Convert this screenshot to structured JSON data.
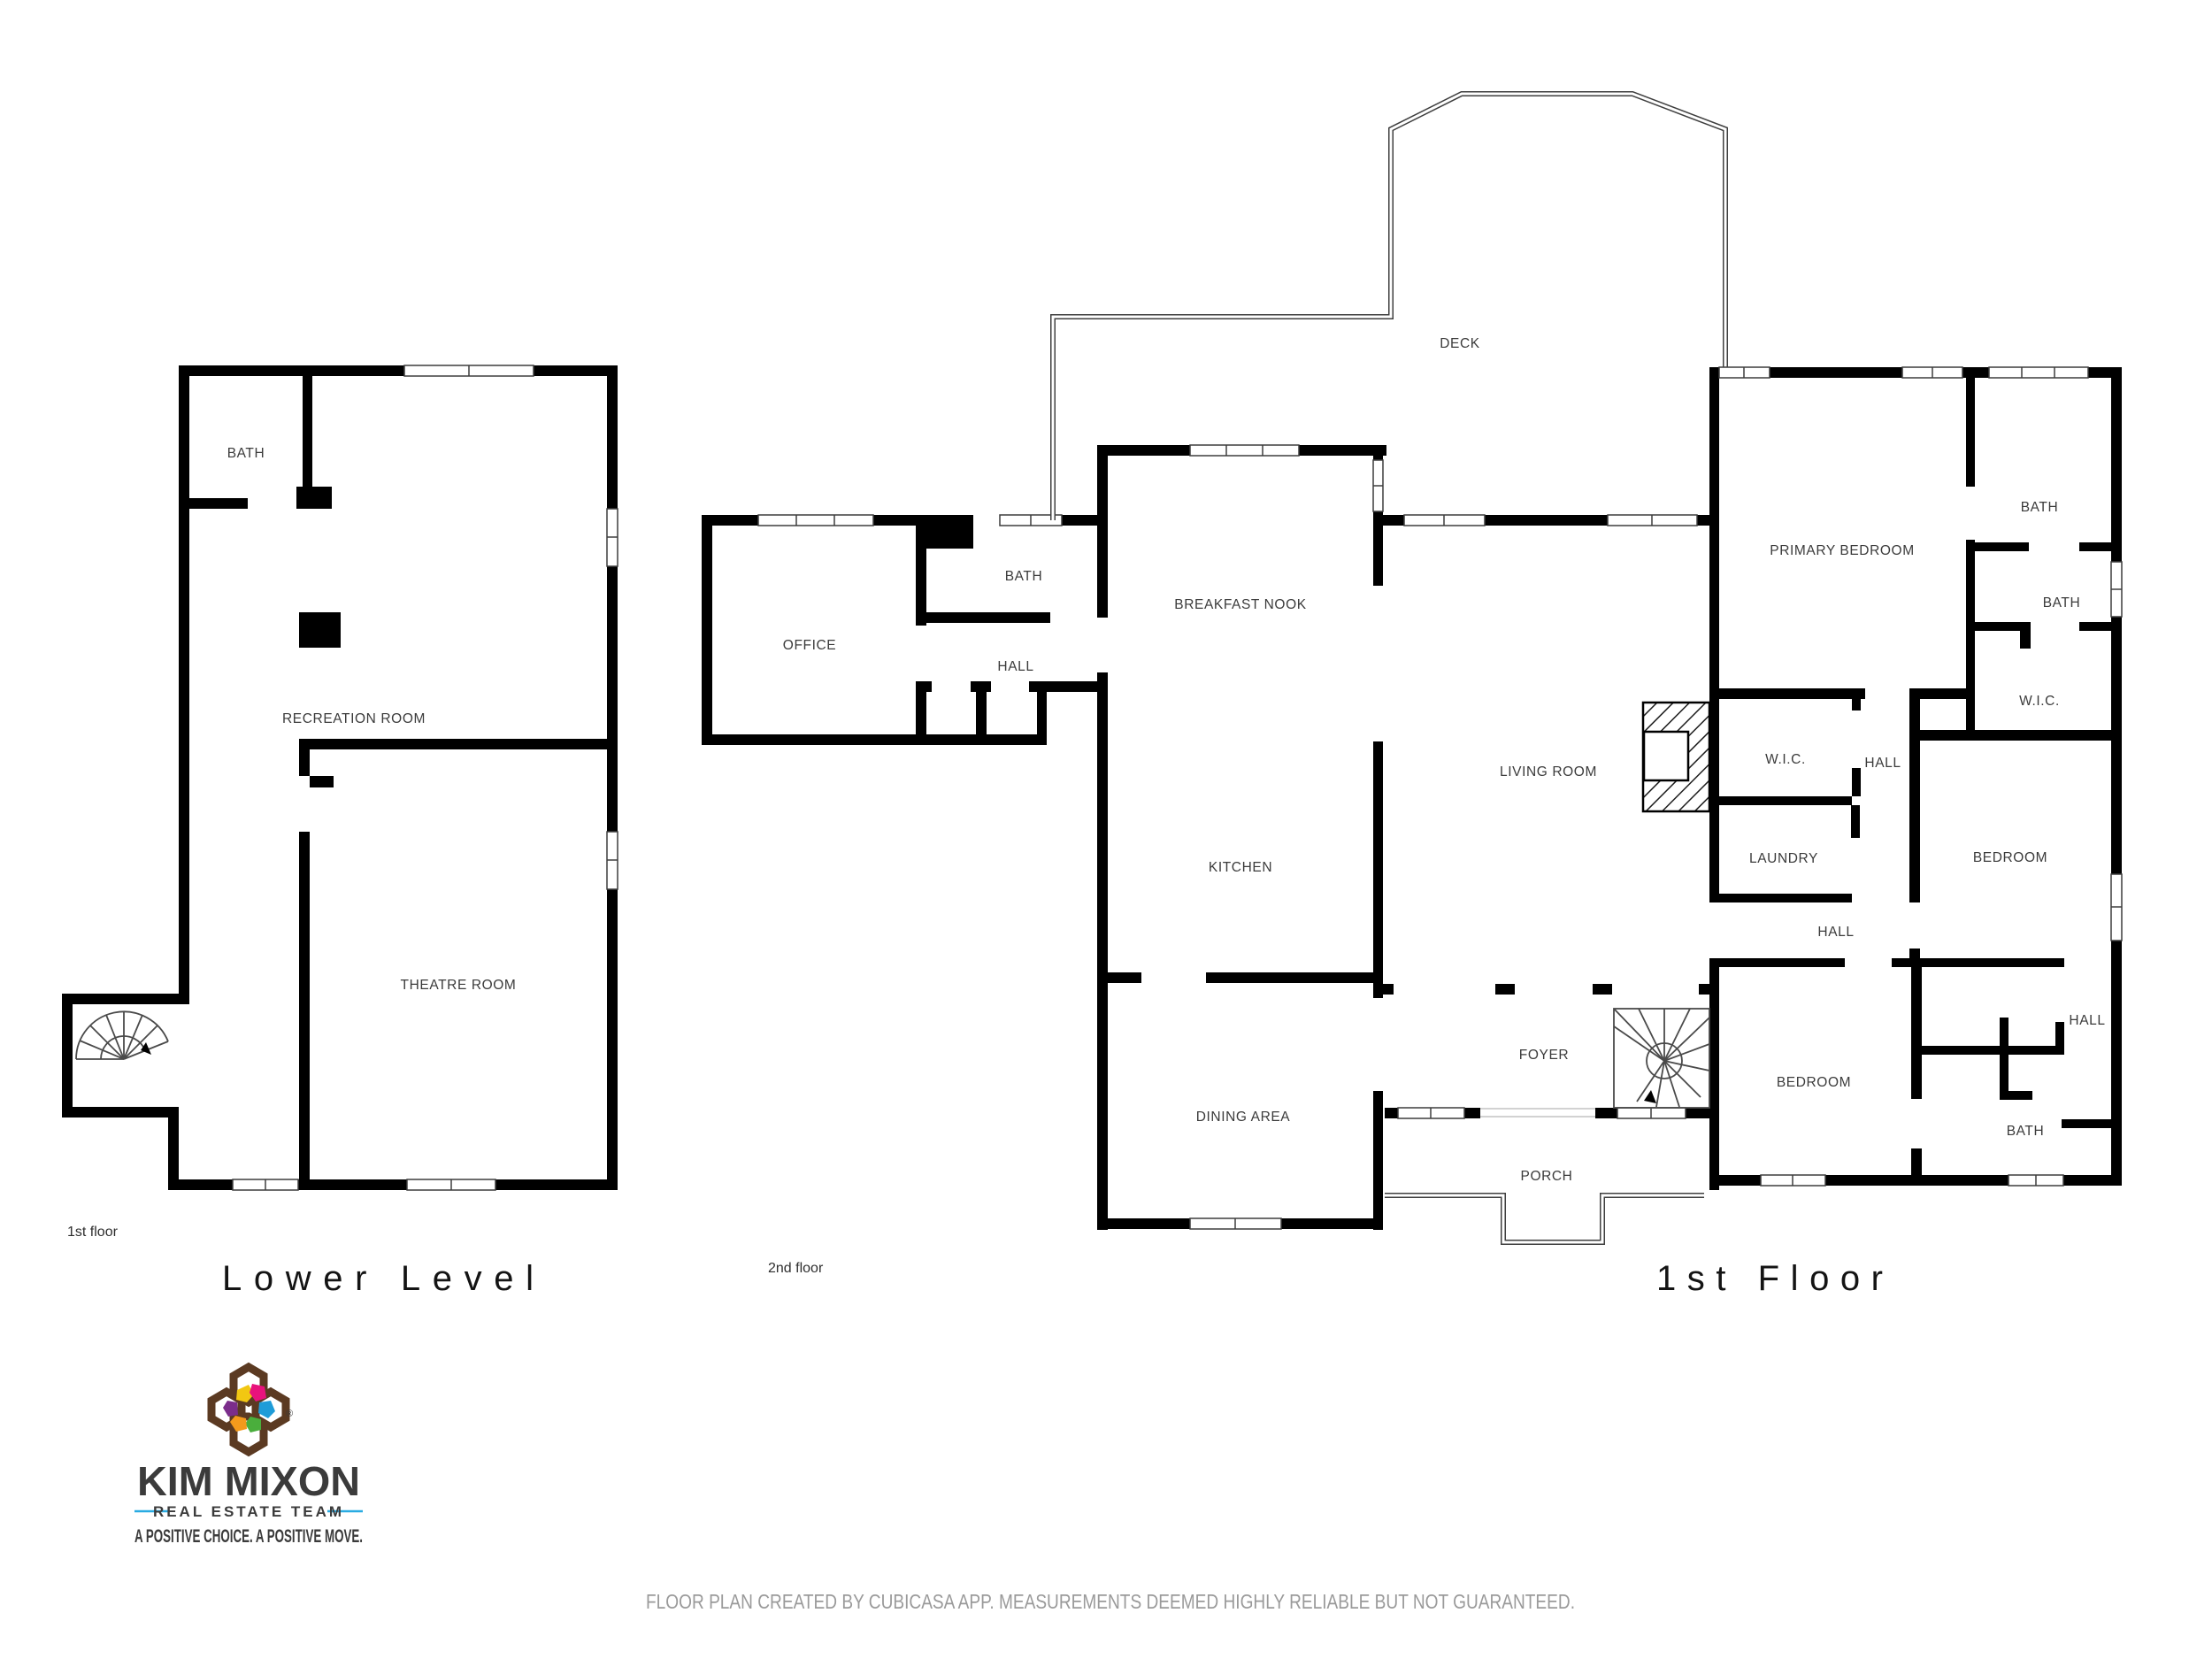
{
  "plans": {
    "lower_level": {
      "title": "Lower Level",
      "floor_tag": "1st floor",
      "rooms": {
        "bath": "BATH",
        "recreation": "RECREATION ROOM",
        "theatre": "THEATRE ROOM"
      }
    },
    "second_floor": {
      "floor_tag": "2nd floor",
      "rooms": {
        "office": "OFFICE",
        "bath": "BATH",
        "hall": "HALL"
      }
    },
    "first_floor": {
      "title": "1st Floor",
      "rooms": {
        "deck": "DECK",
        "breakfast_nook": "BREAKFAST NOOK",
        "kitchen": "KITCHEN",
        "dining": "DINING AREA",
        "living": "LIVING ROOM",
        "foyer": "FOYER",
        "porch": "PORCH",
        "primary_bedroom": "PRIMARY BEDROOM",
        "bath_ne": "BATH",
        "bath_e": "BATH",
        "wic_e": "W.I.C.",
        "wic_c": "W.I.C.",
        "hall_c": "HALL",
        "laundry": "LAUNDRY",
        "bedroom_e": "BEDROOM",
        "hall_mid": "HALL",
        "hall_se": "HALL",
        "bedroom_s": "BEDROOM",
        "bath_s": "BATH"
      }
    }
  },
  "logo": {
    "name": "KIM MIXON",
    "team": "REAL ESTATE TEAM",
    "tagline": "A POSITIVE CHOICE. A POSITIVE MOVE.",
    "registered": "®",
    "colors": {
      "brand_blue": "#29abe2",
      "tagline_pink": "#ec0f7e",
      "icon_brown": "#5b3a22",
      "icon_yellow": "#f2c712",
      "icon_pink": "#e8127c",
      "icon_blue": "#1f9cd8",
      "icon_green": "#4aae3c",
      "icon_orange": "#f49a1c",
      "icon_purple": "#7b2d8b"
    }
  },
  "footer": {
    "disclaimer": "FLOOR PLAN CREATED BY CUBICASA APP. MEASUREMENTS DEEMED HIGHLY RELIABLE BUT NOT GUARANTEED."
  }
}
